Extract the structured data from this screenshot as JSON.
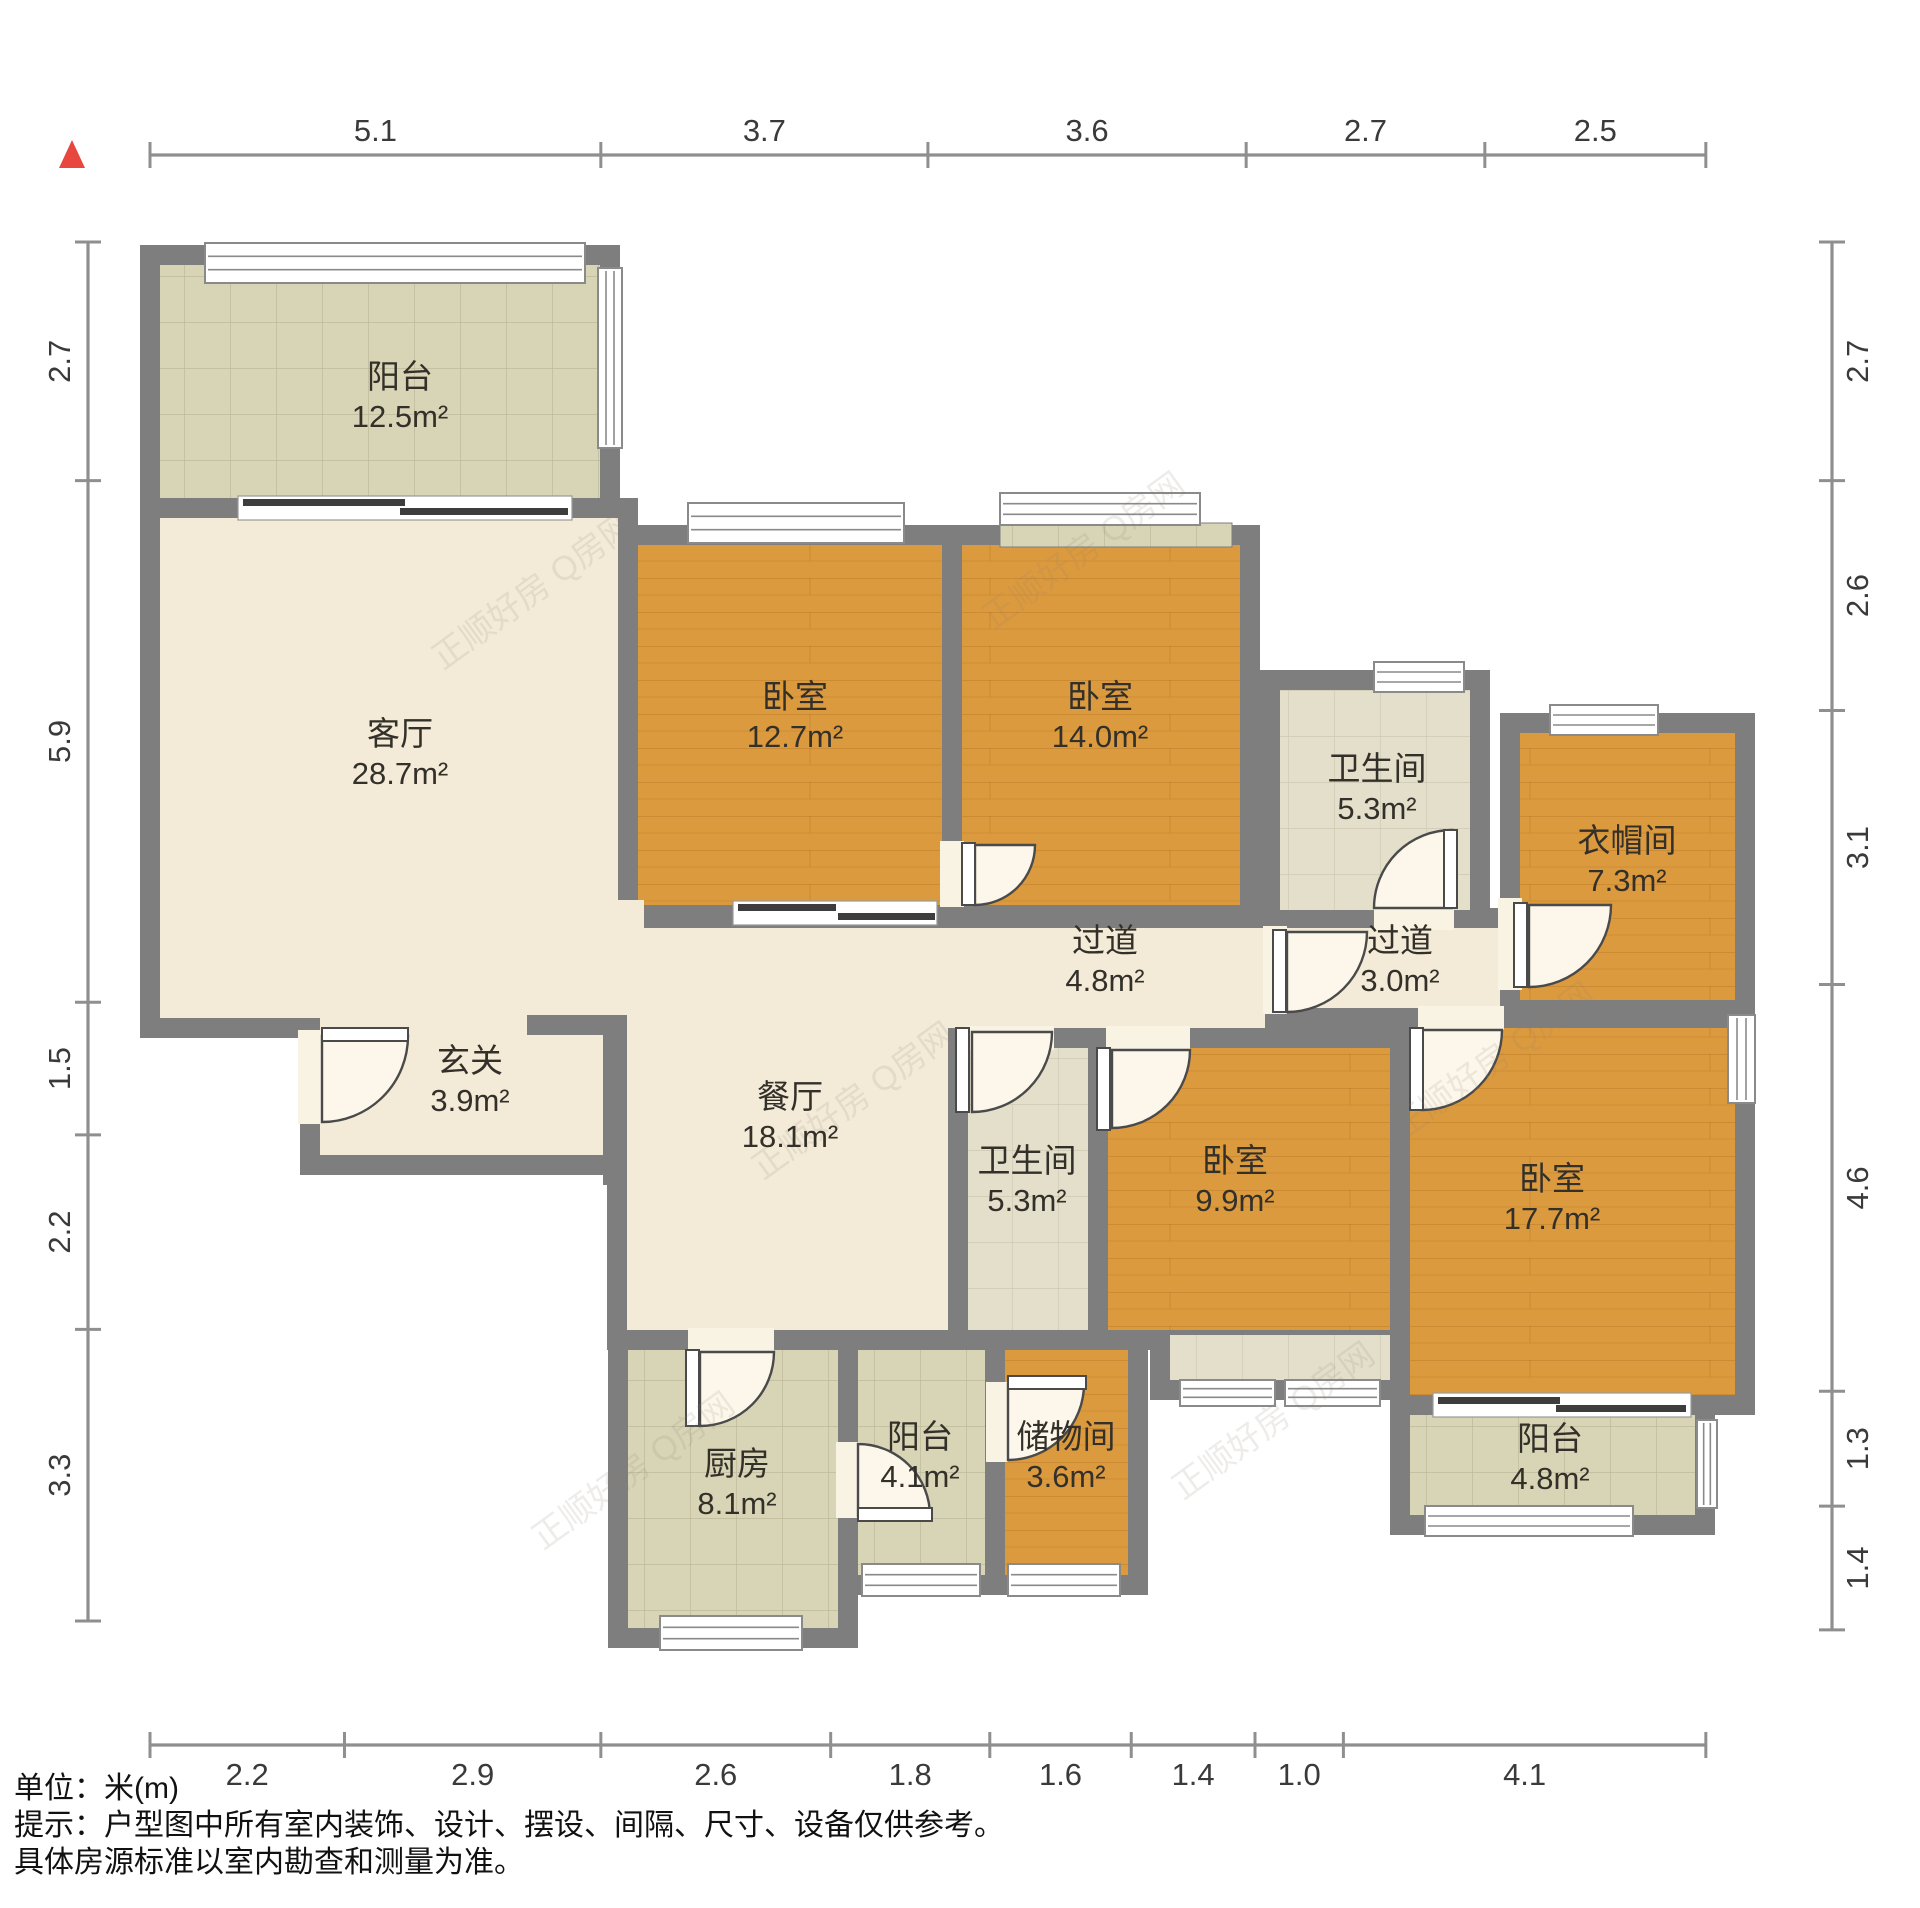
{
  "notes": {
    "unit": "单位：米(m)",
    "tip1": "提示：户型图中所有室内装饰、设计、摆设、间隔、尺寸、设备仅供参考。",
    "tip2": "具体房源标准以室内勘查和测量为准。"
  },
  "colors": {
    "wall": "#7e7e7e",
    "marble": "#f3ead7",
    "tile": "#d8d4b6",
    "tile_line": "#bdb99a",
    "tile_light": "#e3dfcb",
    "tile_light_line": "#cdc9b2",
    "wood": "#dc9a3e",
    "wood_line": "#b5751f",
    "window_fill": "#ffffff",
    "window_stroke": "#8a8a8a",
    "slider_dark": "#3d3d3d",
    "door_stroke": "#4a4a4a",
    "door_fill": "#fcf7ea",
    "opening_fill": "#f9f3e3",
    "dim_line": "#8f8f8f",
    "dim_text": "#3a3a3a",
    "label_text": "#33302a",
    "watermark": "#8d8272",
    "compass": "#e8473f"
  },
  "plan": {
    "wall_thickness": 20,
    "rooms": [
      {
        "id": "balcony-north",
        "name": "阳台",
        "area": "12.5m²",
        "x": 160,
        "y": 265,
        "w": 440,
        "h": 233,
        "floor": "tile",
        "lx": 400,
        "ly": 388
      },
      {
        "id": "living-room",
        "name": "客厅",
        "area": "28.7m²",
        "x": 160,
        "y": 518,
        "w": 458,
        "h": 500,
        "floor": "marble",
        "lx": 400,
        "ly": 745
      },
      {
        "id": "entry-hall",
        "name": "玄关",
        "area": "3.9m²",
        "x": 320,
        "y": 1015,
        "w": 283,
        "h": 140,
        "floor": "marble",
        "lx": 470,
        "ly": 1072
      },
      {
        "id": "bedroom-a",
        "name": "卧室",
        "area": "12.7m²",
        "x": 638,
        "y": 545,
        "w": 304,
        "h": 360,
        "floor": "wood",
        "lx": 795,
        "ly": 708
      },
      {
        "id": "bedroom-b",
        "name": "卧室",
        "area": "14.0m²",
        "x": 962,
        "y": 545,
        "w": 278,
        "h": 360,
        "floor": "wood",
        "lx": 1100,
        "ly": 708
      },
      {
        "id": "bathroom-a",
        "name": "卫生间",
        "area": "5.3m²",
        "x": 1280,
        "y": 690,
        "w": 190,
        "h": 220,
        "floor": "tileL",
        "lx": 1377,
        "ly": 780
      },
      {
        "id": "cloakroom",
        "name": "衣帽间",
        "area": "7.3m²",
        "x": 1520,
        "y": 733,
        "w": 215,
        "h": 267,
        "floor": "wood",
        "lx": 1627,
        "ly": 852
      },
      {
        "id": "hallway-a",
        "name": "过道",
        "area": "4.8m²",
        "x": 638,
        "y": 928,
        "w": 627,
        "h": 100,
        "floor": "marble",
        "lx": 1105,
        "ly": 952
      },
      {
        "id": "hallway-b",
        "name": "过道",
        "area": "3.0m²",
        "x": 1285,
        "y": 928,
        "w": 215,
        "h": 80,
        "floor": "marble",
        "lx": 1400,
        "ly": 952
      },
      {
        "id": "dining-room",
        "name": "餐厅",
        "area": "18.1m²",
        "x": 627,
        "y": 1008,
        "w": 321,
        "h": 322,
        "floor": "marble",
        "lx": 790,
        "ly": 1108
      },
      {
        "id": "bathroom-b",
        "name": "卫生间",
        "area": "5.3m²",
        "x": 968,
        "y": 1048,
        "w": 120,
        "h": 282,
        "floor": "tileL",
        "lx": 1027,
        "ly": 1172
      },
      {
        "id": "bedroom-c",
        "name": "卧室",
        "area": "9.9m²",
        "x": 1108,
        "y": 1048,
        "w": 282,
        "h": 282,
        "floor": "wood",
        "lx": 1235,
        "ly": 1172
      },
      {
        "id": "bedroom-d",
        "name": "卧室",
        "area": "17.7m²",
        "x": 1410,
        "y": 1028,
        "w": 325,
        "h": 367,
        "floor": "wood",
        "lx": 1552,
        "ly": 1190
      },
      {
        "id": "kitchen",
        "name": "厨房",
        "area": "8.1m²",
        "x": 628,
        "y": 1350,
        "w": 210,
        "h": 278,
        "floor": "tile",
        "lx": 737,
        "ly": 1475
      },
      {
        "id": "balcony-south-1",
        "name": "阳台",
        "area": "4.1m²",
        "x": 858,
        "y": 1350,
        "w": 127,
        "h": 225,
        "floor": "tile",
        "lx": 920,
        "ly": 1448
      },
      {
        "id": "storage-room",
        "name": "储物间",
        "area": "3.6m²",
        "x": 1005,
        "y": 1350,
        "w": 123,
        "h": 225,
        "floor": "wood",
        "lx": 1066,
        "ly": 1448
      },
      {
        "id": "vestibule",
        "name": "",
        "area": "",
        "x": 1170,
        "y": 1335,
        "w": 220,
        "h": 45,
        "floor": "tileL",
        "lx": 0,
        "ly": 0
      },
      {
        "id": "balcony-south-2",
        "name": "阳台",
        "area": "4.8m²",
        "x": 1410,
        "y": 1415,
        "w": 285,
        "h": 100,
        "floor": "tile",
        "lx": 1550,
        "ly": 1450
      }
    ],
    "patches": [
      {
        "x": 612,
        "y": 900,
        "w": 32,
        "h": 132,
        "floor": "marble"
      },
      {
        "x": 330,
        "y": 1002,
        "w": 180,
        "h": 26,
        "floor": "marble"
      }
    ],
    "extra_walls": [
      {
        "x": 527,
        "y": 1015,
        "w": 100,
        "h": 20
      },
      {
        "x": 603,
        "y": 1015,
        "w": 24,
        "h": 170
      }
    ],
    "sills": [
      {
        "x": 1000,
        "y": 523,
        "w": 232,
        "h": 24
      }
    ],
    "windows": [
      {
        "x": 205,
        "y": 243,
        "w": 380,
        "h": 40,
        "o": "h"
      },
      {
        "x": 598,
        "y": 268,
        "w": 24,
        "h": 180,
        "o": "v"
      },
      {
        "x": 688,
        "y": 503,
        "w": 216,
        "h": 40,
        "o": "h"
      },
      {
        "x": 1000,
        "y": 493,
        "w": 200,
        "h": 32,
        "o": "h"
      },
      {
        "x": 1374,
        "y": 662,
        "w": 90,
        "h": 30,
        "o": "h"
      },
      {
        "x": 1550,
        "y": 705,
        "w": 108,
        "h": 30,
        "o": "h"
      },
      {
        "x": 1728,
        "y": 1015,
        "w": 27,
        "h": 88,
        "o": "v"
      },
      {
        "x": 1697,
        "y": 1420,
        "w": 20,
        "h": 88,
        "o": "v"
      },
      {
        "x": 1425,
        "y": 1506,
        "w": 208,
        "h": 30,
        "o": "h"
      },
      {
        "x": 660,
        "y": 1616,
        "w": 142,
        "h": 34,
        "o": "h"
      },
      {
        "x": 862,
        "y": 1564,
        "w": 118,
        "h": 32,
        "o": "h"
      },
      {
        "x": 1008,
        "y": 1564,
        "w": 112,
        "h": 32,
        "o": "h"
      },
      {
        "x": 1180,
        "y": 1380,
        "w": 95,
        "h": 26,
        "o": "h"
      },
      {
        "x": 1285,
        "y": 1380,
        "w": 95,
        "h": 26,
        "o": "h"
      }
    ],
    "sliders": [
      {
        "back": [
          238,
          496,
          334,
          24
        ],
        "panels": [
          [
            243,
            499,
            162,
            7
          ],
          [
            400,
            508,
            168,
            7
          ]
        ]
      },
      {
        "back": [
          1433,
          1393,
          258,
          24
        ],
        "panels": [
          [
            1438,
            1397,
            122,
            7
          ],
          [
            1556,
            1405,
            130,
            7
          ]
        ]
      },
      {
        "back": [
          733,
          901,
          204,
          24
        ],
        "panels": [
          [
            738,
            904,
            98,
            7
          ],
          [
            838,
            913,
            97,
            7
          ]
        ]
      }
    ],
    "doors": [
      {
        "id": "entry-door",
        "cx": 322,
        "cy": 1036,
        "r": 86,
        "a0": 0,
        "a1": 90,
        "leaf": [
          322,
          1028,
          86,
          13
        ],
        "open": [
          298,
          1030,
          24,
          94
        ]
      },
      {
        "id": "bedroom-b-door",
        "cx": 975,
        "cy": 845,
        "r": 60,
        "a0": 0,
        "a1": 90,
        "leaf": [
          962,
          843,
          13,
          62
        ],
        "open": [
          940,
          841,
          24,
          66
        ]
      },
      {
        "id": "bathroom-a-door",
        "cx": 1452,
        "cy": 908,
        "r": 78,
        "a0": 180,
        "a1": 270,
        "leaf": [
          1444,
          830,
          13,
          78
        ],
        "open": [
          1374,
          906,
          80,
          24
        ]
      },
      {
        "id": "cloakroom-door",
        "cx": 1529,
        "cy": 905,
        "r": 82,
        "a0": 0,
        "a1": 90,
        "leaf": [
          1514,
          903,
          13,
          84
        ],
        "open": [
          1498,
          898,
          24,
          92
        ]
      },
      {
        "id": "hallway-door",
        "cx": 1287,
        "cy": 932,
        "r": 80,
        "a0": 0,
        "a1": 90,
        "leaf": [
          1273,
          930,
          13,
          82
        ],
        "open": [
          1263,
          926,
          24,
          88
        ]
      },
      {
        "id": "bathroom-b-door",
        "cx": 972,
        "cy": 1032,
        "r": 80,
        "a0": 0,
        "a1": 90,
        "leaf": [
          956,
          1028,
          13,
          84
        ],
        "open": [
          966,
          1026,
          88,
          24
        ]
      },
      {
        "id": "bedroom-c-door",
        "cx": 1112,
        "cy": 1050,
        "r": 78,
        "a0": 0,
        "a1": 90,
        "leaf": [
          1097,
          1048,
          13,
          82
        ],
        "open": [
          1106,
          1026,
          84,
          24
        ]
      },
      {
        "id": "kitchen-door",
        "cx": 700,
        "cy": 1352,
        "r": 74,
        "a0": 0,
        "a1": 90,
        "leaf": [
          686,
          1350,
          13,
          76
        ],
        "open": [
          688,
          1328,
          86,
          24
        ]
      },
      {
        "id": "balcony-s1-door",
        "cx": 858,
        "cy": 1516,
        "r": 72,
        "a0": 270,
        "a1": 360,
        "leaf": [
          858,
          1508,
          74,
          13
        ],
        "open": [
          836,
          1442,
          24,
          76
        ]
      },
      {
        "id": "storage-door",
        "cx": 1008,
        "cy": 1384,
        "r": 76,
        "a0": 0,
        "a1": 90,
        "leaf": [
          1008,
          1376,
          78,
          13
        ],
        "open": [
          986,
          1382,
          22,
          80
        ]
      },
      {
        "id": "bedroom-d-door",
        "cx": 1422,
        "cy": 1030,
        "r": 80,
        "a0": 0,
        "a1": 90,
        "leaf": [
          1410,
          1028,
          13,
          82
        ],
        "open": [
          1418,
          1006,
          86,
          24
        ]
      }
    ],
    "watermarks": [
      {
        "text": "正顺好房 Q房网",
        "x": 540,
        "y": 600,
        "rot": -36
      },
      {
        "text": "正顺好房 Q房网",
        "x": 1090,
        "y": 560,
        "rot": -36
      },
      {
        "text": "正顺好房 Q房网",
        "x": 860,
        "y": 1110,
        "rot": -36
      },
      {
        "text": "正顺好房 Q房网",
        "x": 1500,
        "y": 1070,
        "rot": -36
      },
      {
        "text": "正顺好房 Q房网",
        "x": 640,
        "y": 1480,
        "rot": -36
      },
      {
        "text": "正顺好房 Q房网",
        "x": 1280,
        "y": 1430,
        "rot": -36
      }
    ],
    "compass": {
      "points": "72,140 59,168 85,168"
    }
  },
  "dimensions": {
    "scale_px_per_m": 88.4,
    "top": {
      "axis": "h",
      "x0": 150,
      "y": 155,
      "label_off": -14,
      "labels": [
        "5.1",
        "3.7",
        "3.6",
        "2.7",
        "2.5"
      ]
    },
    "bottom": {
      "axis": "h",
      "x0": 150,
      "y": 1745,
      "label_off": 40,
      "labels": [
        "2.2",
        "2.9",
        "2.6",
        "1.8",
        "1.6",
        "1.4",
        "1.0",
        "4.1"
      ]
    },
    "left": {
      "axis": "v",
      "y0": 242,
      "x": 88,
      "label_off": -18,
      "labels": [
        "2.7",
        "5.9",
        "1.5",
        "2.2",
        "3.3"
      ]
    },
    "right": {
      "axis": "v",
      "y0": 242,
      "x": 1832,
      "label_off": 36,
      "labels": [
        "2.7",
        "2.6",
        "3.1",
        "4.6",
        "1.3",
        "1.4"
      ]
    }
  }
}
